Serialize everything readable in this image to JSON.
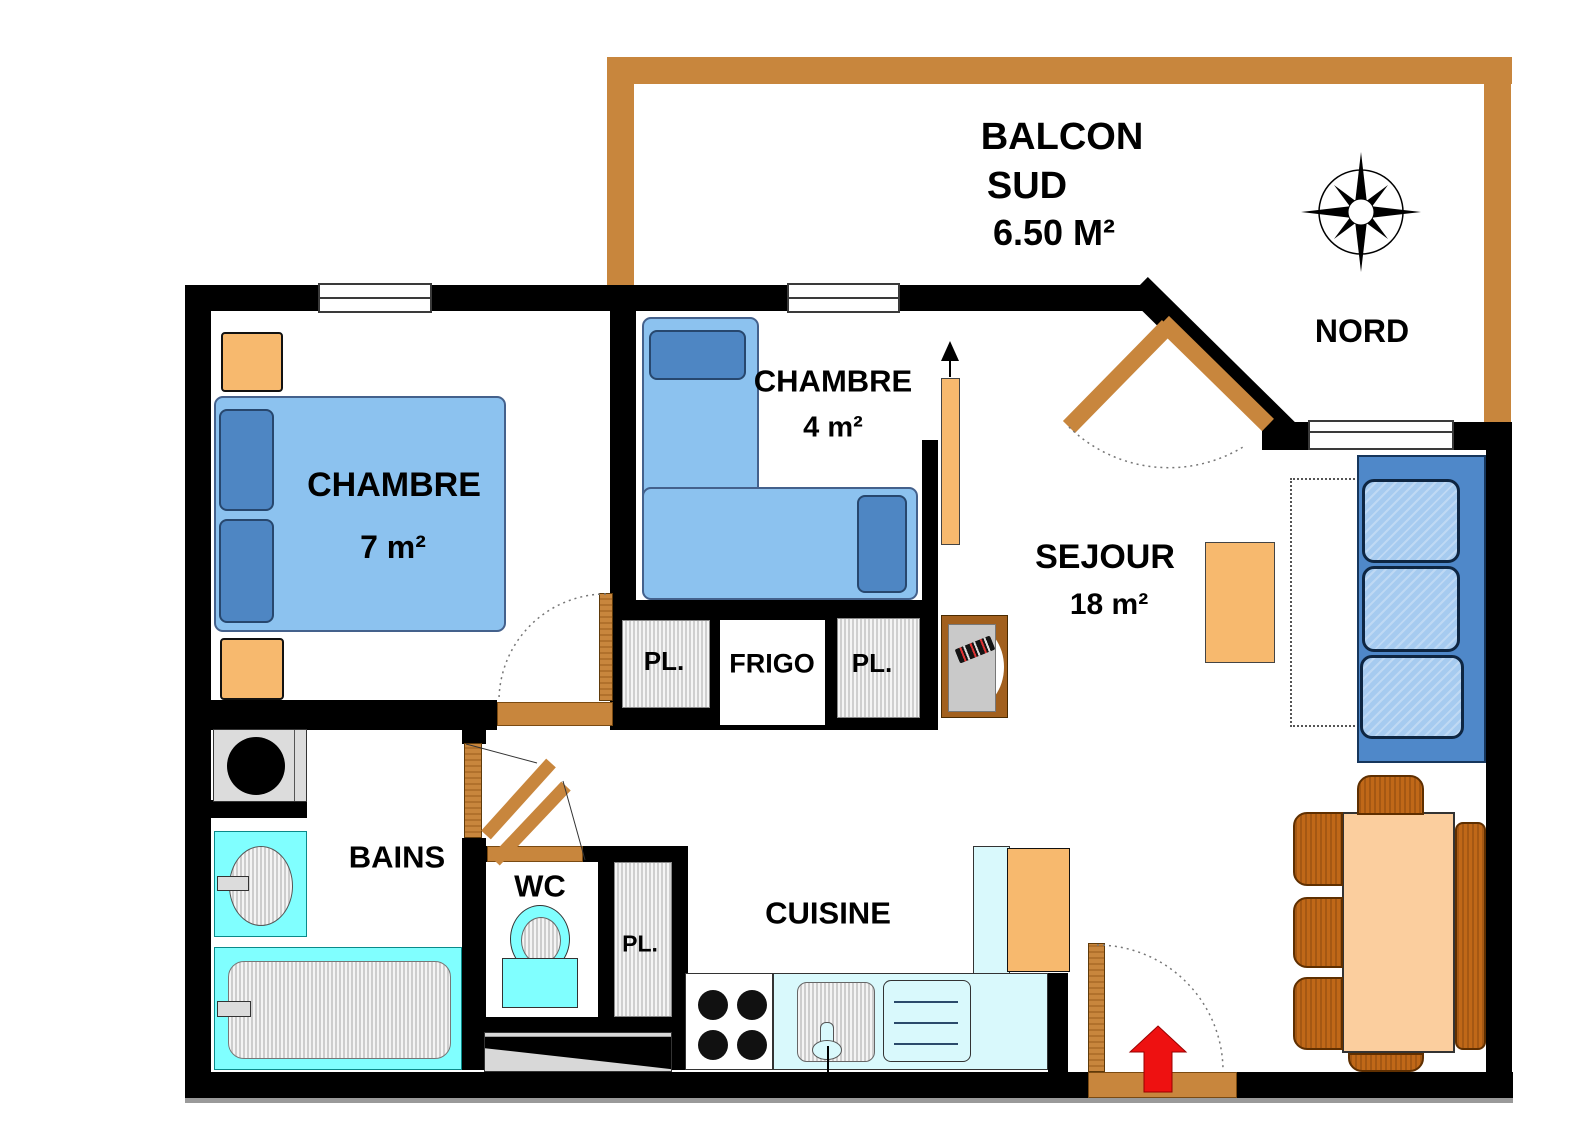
{
  "balcony": {
    "line1": "BALCON",
    "line2": "SUD",
    "line3": "6.50 M²"
  },
  "compass": {
    "label": "NORD"
  },
  "rooms": {
    "chambre7": {
      "name": "CHAMBRE",
      "area": "7 m²"
    },
    "chambre4": {
      "name": "CHAMBRE",
      "area": "4 m²"
    },
    "sejour": {
      "name": "SEJOUR",
      "area": "18 m²"
    },
    "bains": {
      "name": "BAINS"
    },
    "wc": {
      "name": "WC"
    },
    "cuisine": {
      "name": "CUISINE"
    }
  },
  "storage": {
    "pl1": "PL.",
    "frigo": "FRIGO",
    "pl2": "PL.",
    "pl3": "PL."
  },
  "colors": {
    "wall": "#000000",
    "balcony_wall": "#C8863D",
    "door": "#C8863D",
    "furniture_orange": "#F7B96E",
    "table_peach": "#FBCE9E",
    "chair_brown": "#C06818",
    "bed_blue": "#8CC2EF",
    "pillow_blue": "#4E86C3",
    "sofa_base": "#4F88C9",
    "sofa_cushion": "#A6CBF0",
    "fixture_cyan": "#80FFFF",
    "counter_cyan": "#D9F9FC",
    "fixture_gray": "#DCDCDC",
    "entry_arrow_red": "#EE1111"
  }
}
